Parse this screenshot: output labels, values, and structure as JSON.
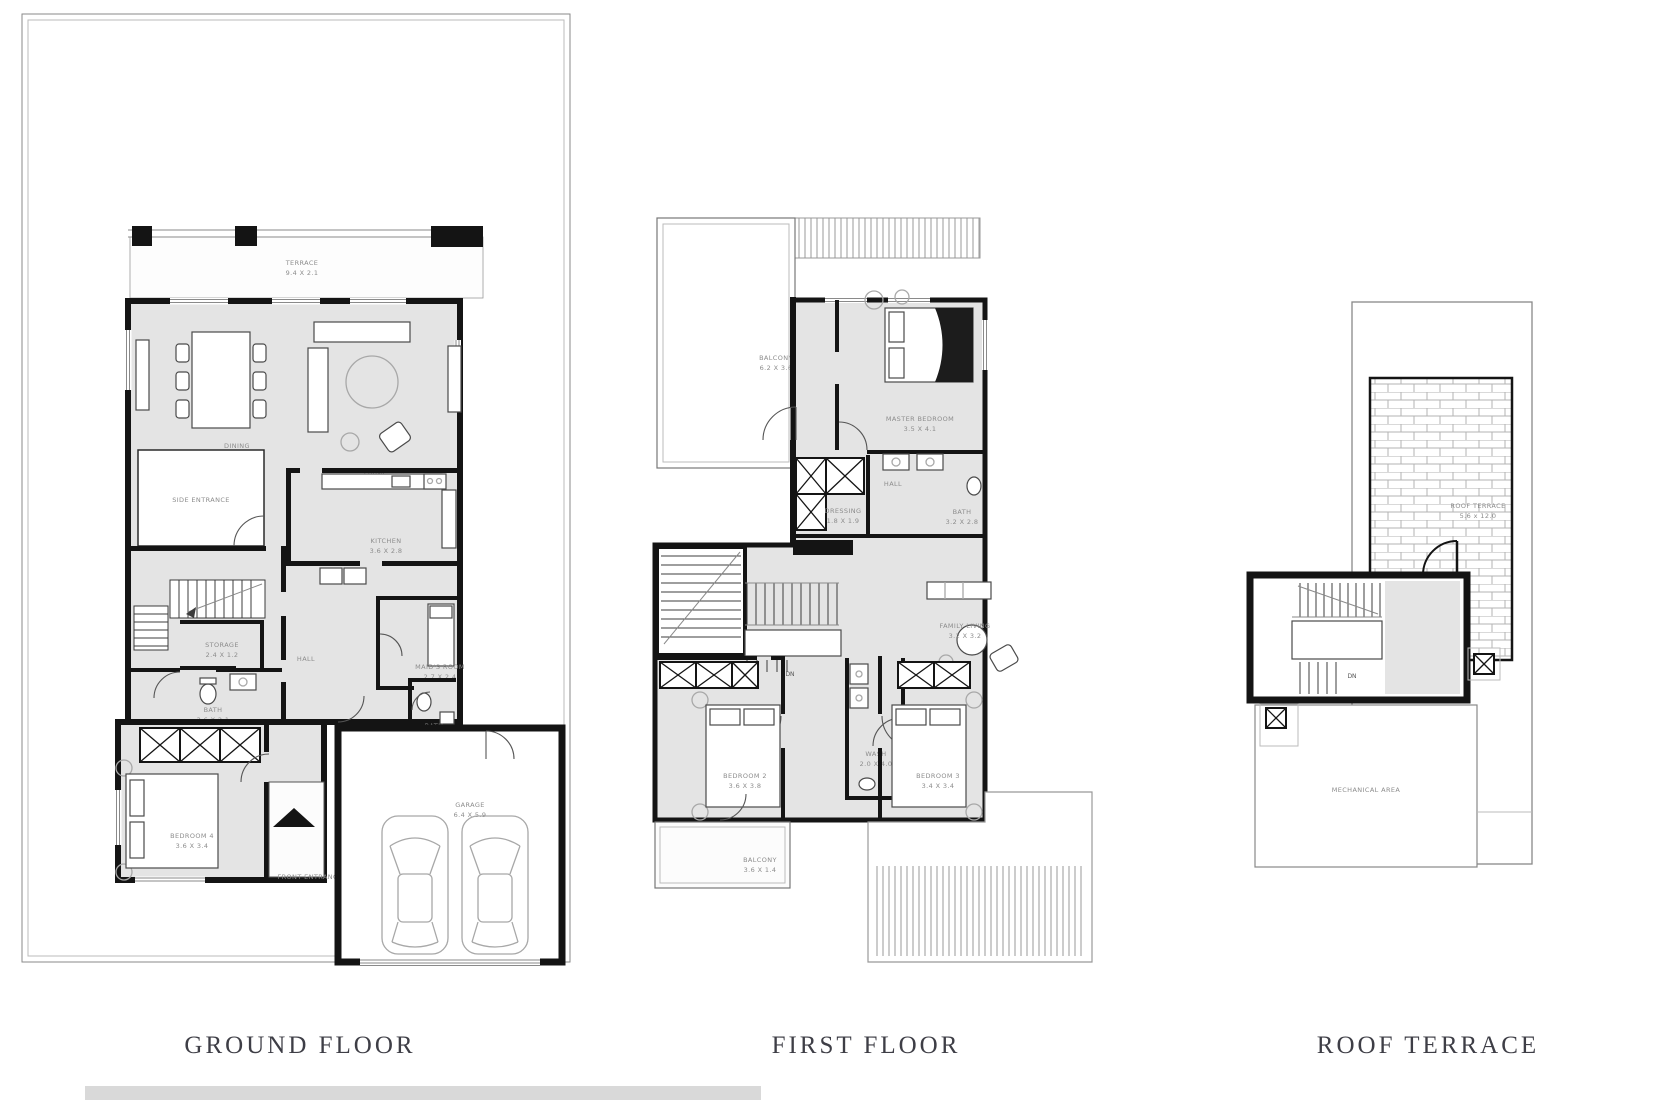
{
  "captions": {
    "ground": "GROUND FLOOR",
    "first": "FIRST FLOOR",
    "roof": "ROOF TERRACE"
  },
  "colors": {
    "wall": "#141414",
    "room_fill": "#e4e4e4",
    "label_text": "#8c8c8c",
    "caption_text": "#3e3e46",
    "bottom_bar": "#d9d9d9"
  },
  "ground": {
    "terrace_name": "TERRACE",
    "terrace_dims": "9.4 X 2.1",
    "dining_name": "DINING",
    "dining_dims": "3.4 X 4.1",
    "living_name": "LIVING",
    "living_dims": "4.3 X 5.1",
    "side_entrance": "SIDE ENTRANCE",
    "kitchen_name": "KITCHEN",
    "kitchen_dims": "3.6 X 2.8",
    "storage_name": "STORAGE",
    "storage_dims": "2.4 X 1.2",
    "hall": "HALL",
    "maids_name": "MAID'S ROOM",
    "maids_dims": "2.7 X 2.4",
    "bath1_name": "BATH",
    "bath1_dims": "3.6 X 2.1",
    "foyer_name": "FOYER",
    "foyer_dims": "3.5 X 1.1",
    "bath2_name": "BATH",
    "bath2_dims": "1.7 X 2.2",
    "bedroom4_name": "BEDROOM 4",
    "bedroom4_dims": "3.6 X 3.4",
    "front_entrance": "FRONT ENTRANCE",
    "garage_name": "GARAGE",
    "garage_dims": "6.4 X 5.9"
  },
  "first": {
    "balcony1_name": "BALCONY",
    "balcony1_dims": "6.2 X 3.6",
    "master_name": "MASTER BEDROOM",
    "master_dims": "3.5 X 4.1",
    "hall": "HALL",
    "dressing_name": "DRESSING",
    "dressing_dims": "1.8 X 1.9",
    "bath_name": "BATH",
    "bath_dims": "3.2 X 2.8",
    "family_name": "FAMILY LIVING",
    "family_dims": "3.2 X 3.2",
    "wash_name": "WASH",
    "wash_dims": "2.0 X 4.0",
    "bedroom2_name": "BEDROOM 2",
    "bedroom2_dims": "3.6 X 3.8",
    "bedroom3_name": "BEDROOM 3",
    "bedroom3_dims": "3.4 X 3.4",
    "balcony2_name": "BALCONY",
    "balcony2_dims": "3.6 X 1.4",
    "dn": "DN"
  },
  "roof": {
    "terrace_name": "ROOF TERRACE",
    "terrace_dims": "5.6 x 12.0",
    "mechanical": "MECHANICAL AREA",
    "dn": "DN"
  }
}
